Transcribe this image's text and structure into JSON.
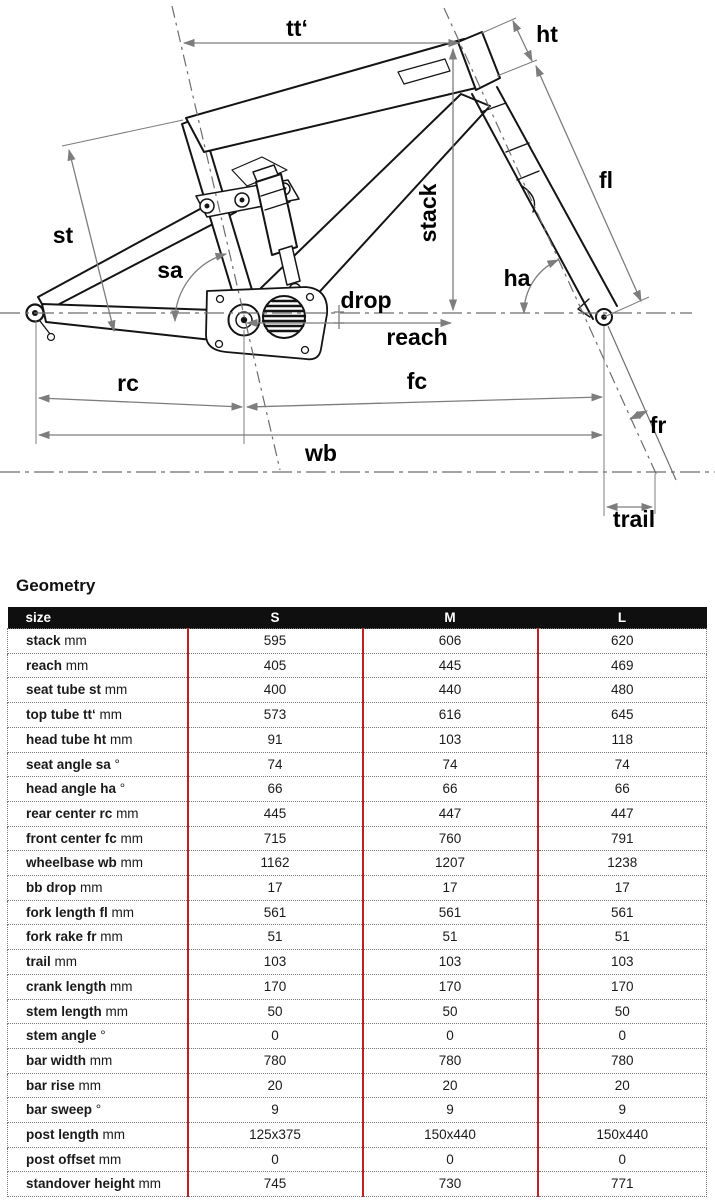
{
  "diagram": {
    "labels": {
      "tt": "tt‘",
      "ht": "ht",
      "st": "st",
      "sa": "sa",
      "stack": "stack",
      "fl": "fl",
      "ha": "ha",
      "drop": "drop",
      "reach": "reach",
      "rc": "rc",
      "fc": "fc",
      "fr": "fr",
      "wb": "wb",
      "trail": "trail"
    }
  },
  "geometry": {
    "heading": "Geometry",
    "table": {
      "size_label": "size",
      "sizes": [
        "S",
        "M",
        "L"
      ],
      "rows": [
        {
          "label": "stack",
          "unit": "mm",
          "values": [
            "595",
            "606",
            "620"
          ]
        },
        {
          "label": "reach",
          "unit": "mm",
          "values": [
            "405",
            "445",
            "469"
          ]
        },
        {
          "label": "seat tube st",
          "unit": "mm",
          "values": [
            "400",
            "440",
            "480"
          ]
        },
        {
          "label": "top tube tt‘",
          "unit": "mm",
          "values": [
            "573",
            "616",
            "645"
          ]
        },
        {
          "label": "head tube ht",
          "unit": "mm",
          "values": [
            "91",
            "103",
            "118"
          ]
        },
        {
          "label": "seat angle sa",
          "unit": "°",
          "values": [
            "74",
            "74",
            "74"
          ]
        },
        {
          "label": "head angle ha",
          "unit": "°",
          "values": [
            "66",
            "66",
            "66"
          ]
        },
        {
          "label": "rear center rc",
          "unit": "mm",
          "values": [
            "445",
            "447",
            "447"
          ]
        },
        {
          "label": "front center fc",
          "unit": "mm",
          "values": [
            "715",
            "760",
            "791"
          ]
        },
        {
          "label": "wheelbase wb",
          "unit": "mm",
          "values": [
            "1162",
            "1207",
            "1238"
          ]
        },
        {
          "label": "bb drop",
          "unit": "mm",
          "values": [
            "17",
            "17",
            "17"
          ]
        },
        {
          "label": "fork length fl",
          "unit": "mm",
          "values": [
            "561",
            "561",
            "561"
          ]
        },
        {
          "label": "fork rake fr",
          "unit": "mm",
          "values": [
            "51",
            "51",
            "51"
          ]
        },
        {
          "label": "trail",
          "unit": "mm",
          "values": [
            "103",
            "103",
            "103"
          ]
        },
        {
          "label": "crank length",
          "unit": "mm",
          "values": [
            "170",
            "170",
            "170"
          ]
        },
        {
          "label": "stem length",
          "unit": "mm",
          "values": [
            "50",
            "50",
            "50"
          ]
        },
        {
          "label": "stem angle",
          "unit": "°",
          "values": [
            "0",
            "0",
            "0"
          ]
        },
        {
          "label": "bar width",
          "unit": "mm",
          "values": [
            "780",
            "780",
            "780"
          ]
        },
        {
          "label": "bar rise",
          "unit": "mm",
          "values": [
            "20",
            "20",
            "20"
          ]
        },
        {
          "label": "bar sweep",
          "unit": "°",
          "values": [
            "9",
            "9",
            "9"
          ]
        },
        {
          "label": "post length",
          "unit": "mm",
          "values": [
            "125x375",
            "150x440",
            "150x440"
          ]
        },
        {
          "label": "post offset",
          "unit": "mm",
          "values": [
            "0",
            "0",
            "0"
          ]
        },
        {
          "label": "standover height",
          "unit": "mm",
          "values": [
            "745",
            "730",
            "771"
          ]
        }
      ]
    }
  },
  "colors": {
    "accent_red": "#bf2026",
    "header_bg": "#0f0f0f",
    "header_text": "#ffffff",
    "frame_line": "#141414",
    "dimension_gray": "#7d7d7d"
  }
}
